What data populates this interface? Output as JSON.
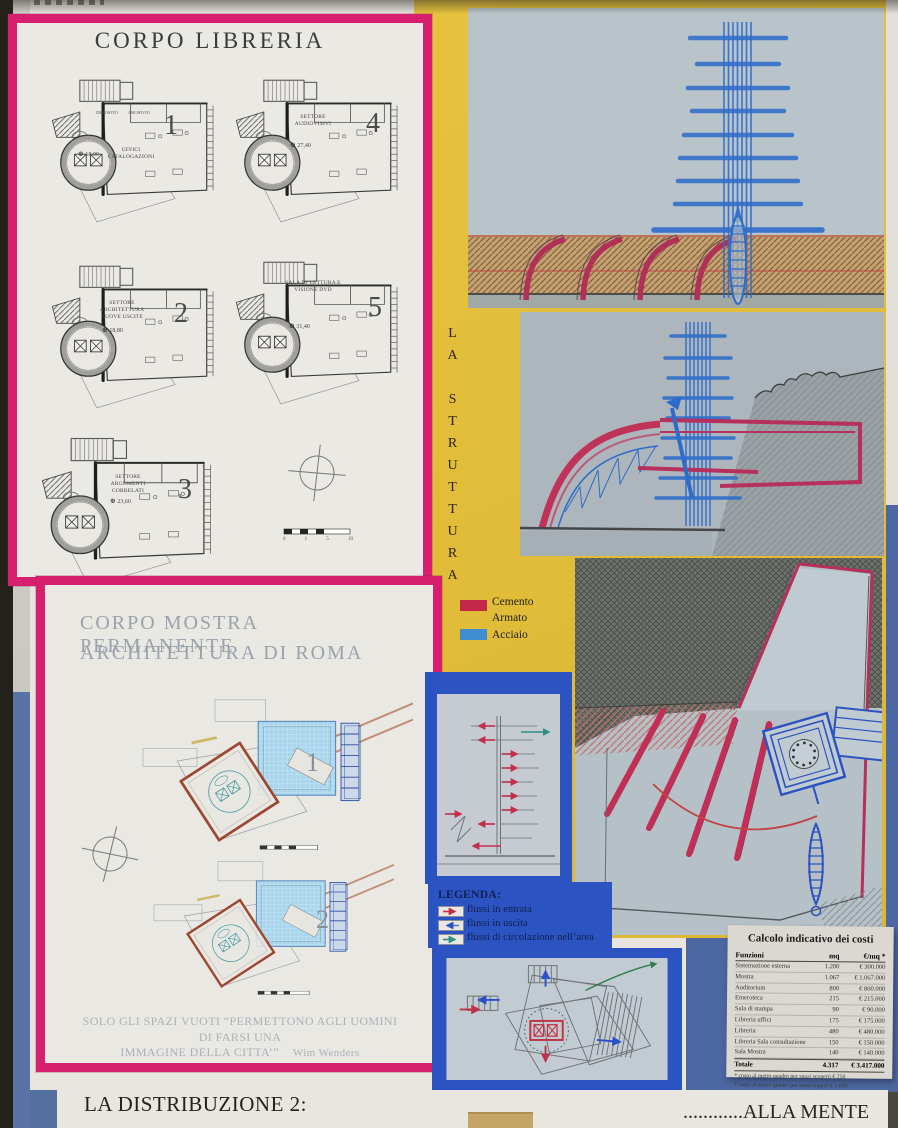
{
  "poster": {
    "libreria": {
      "title": "CORPO  LIBRERIA",
      "plans": [
        {
          "number": "1",
          "rooms": [
            "DEPOSITO",
            "ARCHIVIO"
          ],
          "area": "18,00",
          "label": "UFFICI CATALOGAZIONI"
        },
        {
          "number": "4",
          "area": "27,40",
          "label": "SETTORE AUDIOVISIVI"
        },
        {
          "number": "2",
          "area": "18,80",
          "label": "SETTORE ARCHITETTURA NUOVE USCITE"
        },
        {
          "number": "5",
          "area": "31,40",
          "label": "SALA DI LETTURA E VISIONE DVD"
        },
        {
          "number": "3",
          "area": "23,60",
          "label": "SETTORE ARGOMENTI CORRELATI"
        }
      ],
      "scale_ticks": [
        "0",
        "1",
        "5",
        "10"
      ]
    },
    "mostra": {
      "title_line1": "CORPO  MOSTRA PERMANENTE",
      "title_line2": "ARCHITETTURA DI ROMA",
      "plan_numbers": [
        "1",
        "2"
      ],
      "quote_line1": "SOLO GLI SPAZI VUOTI “PERMETTONO AGLI UOMINI DI FARSI UNA",
      "quote_line2": "IMMAGINE DELLA CITTA’”",
      "quote_author": "Wim Wenders"
    },
    "struttura": {
      "vertical_title": "LA STRUTTURA",
      "materials": [
        {
          "label": "Cemento Armato",
          "color": "#c42848"
        },
        {
          "label": "Acciaio",
          "color": "#3f8fd0"
        }
      ]
    },
    "legenda": {
      "title": "LEGENDA:",
      "items": [
        {
          "label": "flussi in entrata",
          "color": "#c0304a"
        },
        {
          "label": "flussi in uscita",
          "color": "#4a7fd4"
        },
        {
          "label": "flussi di circolazione nell’area",
          "color": "#2e8f85"
        }
      ]
    },
    "costs": {
      "title": "Calcolo indicativo dei costi",
      "columns": [
        "Funzioni",
        "mq",
        "€/mq *"
      ],
      "rows": [
        [
          "Sistemazione esterna",
          "1.200",
          "€ 300.000"
        ],
        [
          "Mostra",
          "1.067",
          "€ 1.067.000"
        ],
        [
          "Auditorium",
          "800",
          "€ 800.000"
        ],
        [
          "Emeroteca",
          "215",
          "€ 215.000"
        ],
        [
          "Sala di stampa",
          "90",
          "€ 90.000"
        ],
        [
          "Libreria uffici",
          "175",
          "€ 175.000"
        ],
        [
          "Libreria",
          "480",
          "€ 480.000"
        ],
        [
          "Libreria Sala consultazione",
          "150",
          "€ 150.000"
        ],
        [
          "Sala Mostra",
          "140",
          "€ 140.000"
        ]
      ],
      "total": [
        "Totale",
        "4.317",
        "€ 3.417.000"
      ],
      "footnotes": [
        "* costo al metro quadro per spazi scoperti € 250",
        "* costo al metro quadro per spazi coperti € 1.000"
      ]
    },
    "footer": {
      "left": "LA DISTRIBUZIONE 2:",
      "right": "............ALLA MENTE"
    }
  }
}
